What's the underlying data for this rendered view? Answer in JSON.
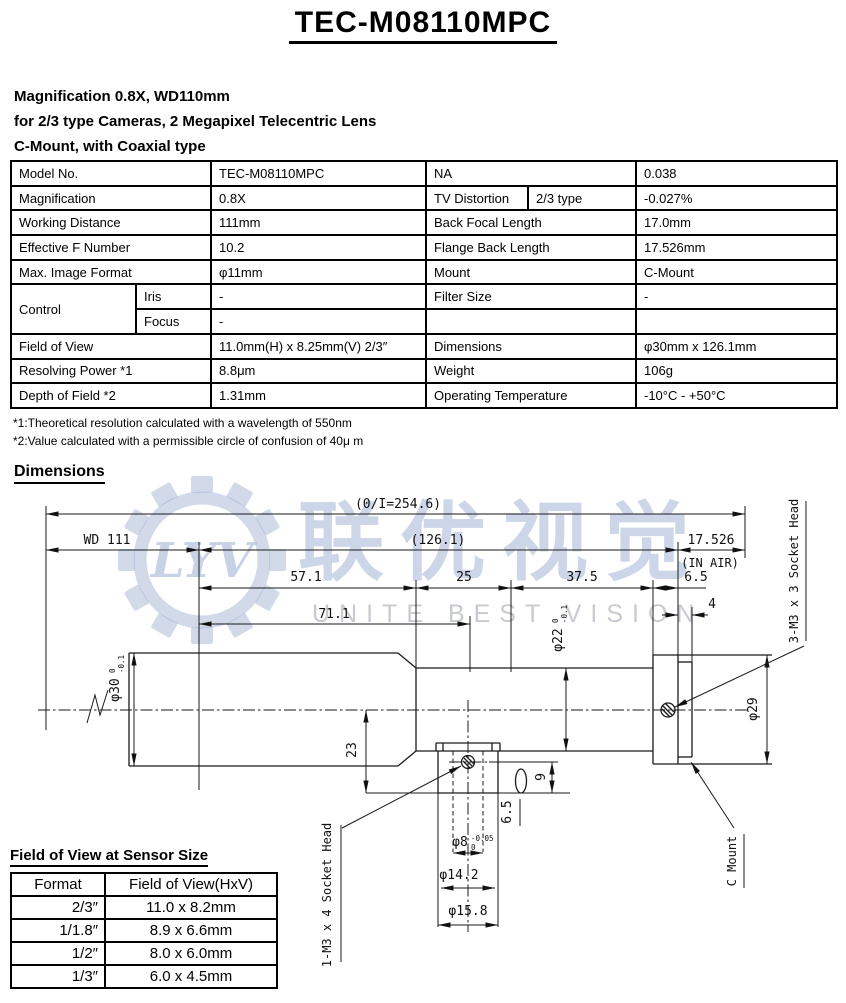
{
  "title": "TEC-M08110MPC",
  "subtitle_lines": [
    "Magnification 0.8X, WD110mm",
    "for 2/3 type Cameras, 2 Megapixel Telecentric Lens",
    "C-Mount, with Coaxial type"
  ],
  "spec_table": {
    "rows": [
      [
        "Model No.",
        "TEC-M08110MPC",
        "NA",
        "0.038"
      ],
      [
        "Magnification",
        "0.8X",
        "TV Distortion",
        "2/3 type",
        "-0.027%"
      ],
      [
        "Working Distance",
        "111mm",
        "Back Focal Length",
        "17.0mm"
      ],
      [
        "Effective F Number",
        "10.2",
        "Flange Back Length",
        "17.526mm"
      ],
      [
        "Max. Image Format",
        "φ11mm",
        "Mount",
        "C-Mount"
      ],
      [
        "Control",
        "Iris",
        "-",
        "Filter Size",
        "-"
      ],
      [
        "Focus",
        "-"
      ],
      [
        "Field of View",
        "11.0mm(H) x 8.25mm(V) 2/3″",
        "Dimensions",
        "φ30mm x 126.1mm"
      ],
      [
        "Resolving Power *1",
        "8.8μm",
        "Weight",
        "106g"
      ],
      [
        "Depth of Field *2",
        "1.31mm",
        "Operating Temperature",
        "-10°C - +50°C"
      ]
    ]
  },
  "footnotes": [
    "*1:Theoretical resolution calculated with a wavelength of 550nm",
    "*2:Value calculated with a permissible circle of confusion of 40μ m"
  ],
  "dimensions_heading": "Dimensions",
  "drawing": {
    "overall": "(0/I=254.6)",
    "wd": "WD 111",
    "body_len": "(126.1)",
    "flange_back": "17.526",
    "in_air": "(IN AIR)",
    "seg1": "57.1",
    "seg2": "25",
    "seg3": "37.5",
    "seg4": "6.5",
    "thread_len": "4",
    "front_len": "71.1",
    "dia30": "φ30",
    "d30_top": "0",
    "d30_bot": "-0.1",
    "dia22": "φ22",
    "d22_top": "0",
    "d22_bot": "-0.1",
    "dia29": "φ29",
    "port_offset": "23",
    "port_len": "9",
    "port_depth": "6.5",
    "dia8": "φ8",
    "d8_top": "-0.05",
    "d8_bot": "0",
    "dia142": "φ14.2",
    "dia158": "φ15.8",
    "flange_screw": "3-M3 x 3 Socket Head",
    "port_screw": "1-M3 x 4 Socket Head",
    "mount": "C Mount"
  },
  "watermark": {
    "logo_text": "LYV",
    "cn": "联优视觉",
    "en": "UNITE BEST VISION",
    "color": "#a3b4d5"
  },
  "fov_table": {
    "heading": "Field of View at Sensor Size",
    "columns": [
      "Format",
      "Field of View(HxV)"
    ],
    "rows": [
      [
        "2/3″",
        "11.0 x 8.2mm"
      ],
      [
        "1/1.8″",
        "8.9 x 6.6mm"
      ],
      [
        "1/2″",
        "8.0 x 6.0mm"
      ],
      [
        "1/3″",
        "6.0 x 4.5mm"
      ]
    ]
  }
}
